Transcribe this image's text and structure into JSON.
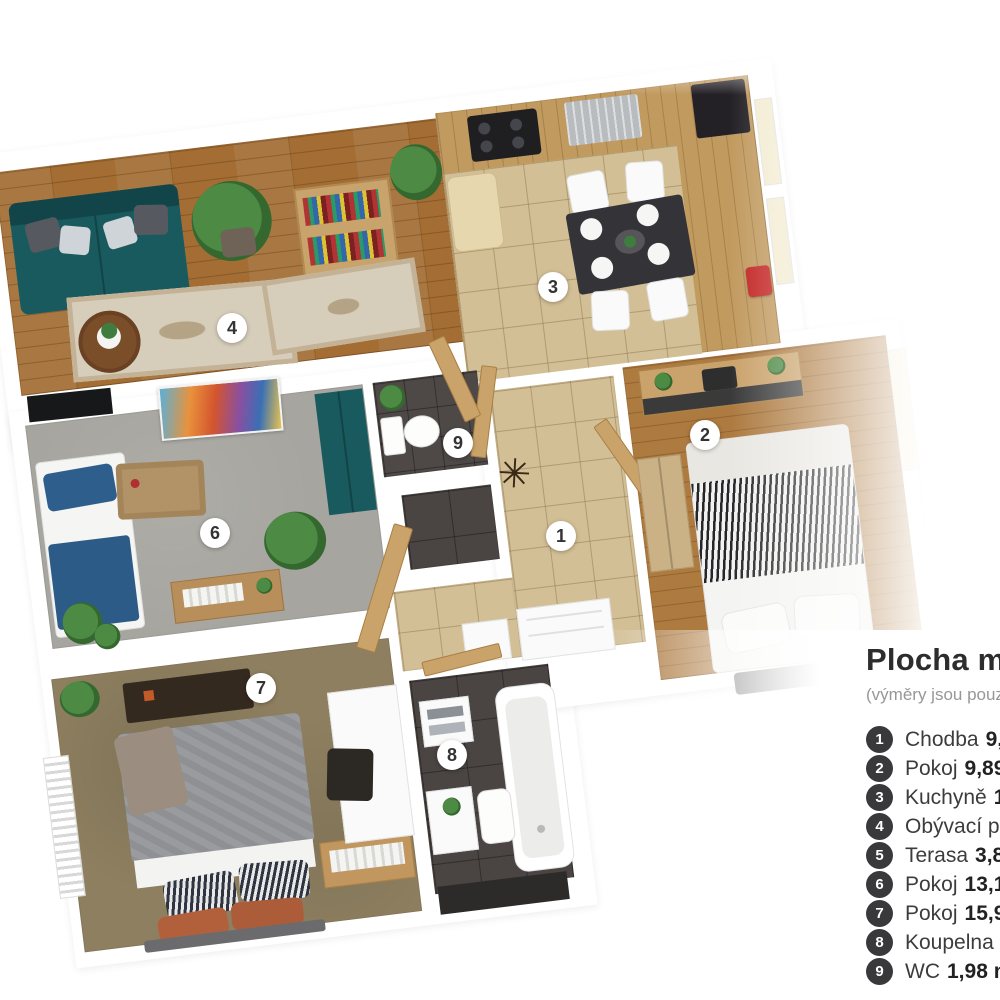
{
  "legend": {
    "title": "Plocha m",
    "subtitle": "(výměry jsou pouz",
    "items": [
      {
        "number": "1",
        "name": "Chodba",
        "value": "9,"
      },
      {
        "number": "2",
        "name": "Pokoj",
        "value": "9,89"
      },
      {
        "number": "3",
        "name": "Kuchyně",
        "value": "1"
      },
      {
        "number": "4",
        "name": "Obývací po",
        "value": ""
      },
      {
        "number": "5",
        "name": "Terasa",
        "value": "3,8"
      },
      {
        "number": "6",
        "name": "Pokoj",
        "value": "13,1"
      },
      {
        "number": "7",
        "name": "Pokoj",
        "value": "15,9"
      },
      {
        "number": "8",
        "name": "Koupelna",
        "value": ""
      },
      {
        "number": "9",
        "name": "WC",
        "value": "1,98 m"
      }
    ]
  },
  "badges": {
    "r1": "1",
    "r2": "2",
    "r3": "3",
    "r4": "4",
    "r6": "6",
    "r7": "7",
    "r8": "8",
    "r9": "9"
  },
  "rooms": [
    {
      "badge": "1",
      "type": "hallway-tile"
    },
    {
      "badge": "2",
      "type": "bedroom-wood"
    },
    {
      "badge": "3",
      "type": "kitchen-tile"
    },
    {
      "badge": "4",
      "type": "living-room-wood"
    },
    {
      "badge": "5",
      "type": "terrace-not-visible"
    },
    {
      "badge": "6",
      "type": "room-gray-carpet"
    },
    {
      "badge": "7",
      "type": "bedroom-olive-carpet"
    },
    {
      "badge": "8",
      "type": "bathroom-dark-tile"
    },
    {
      "badge": "9",
      "type": "wc-dark-tile"
    }
  ],
  "colors": {
    "sofa_teal": "#195a5e",
    "wood_floor": "#a36d33",
    "tile_floor": "#d3bf96",
    "dark_tile": "#4a4542",
    "carpet_gray": "#a6a59f",
    "carpet_olive": "#8e7f60",
    "legend_circle": "#39393b",
    "badge_bg": "#ffffff",
    "accent_red": "#c32424",
    "blue_bedding": "#2d5e8c"
  }
}
